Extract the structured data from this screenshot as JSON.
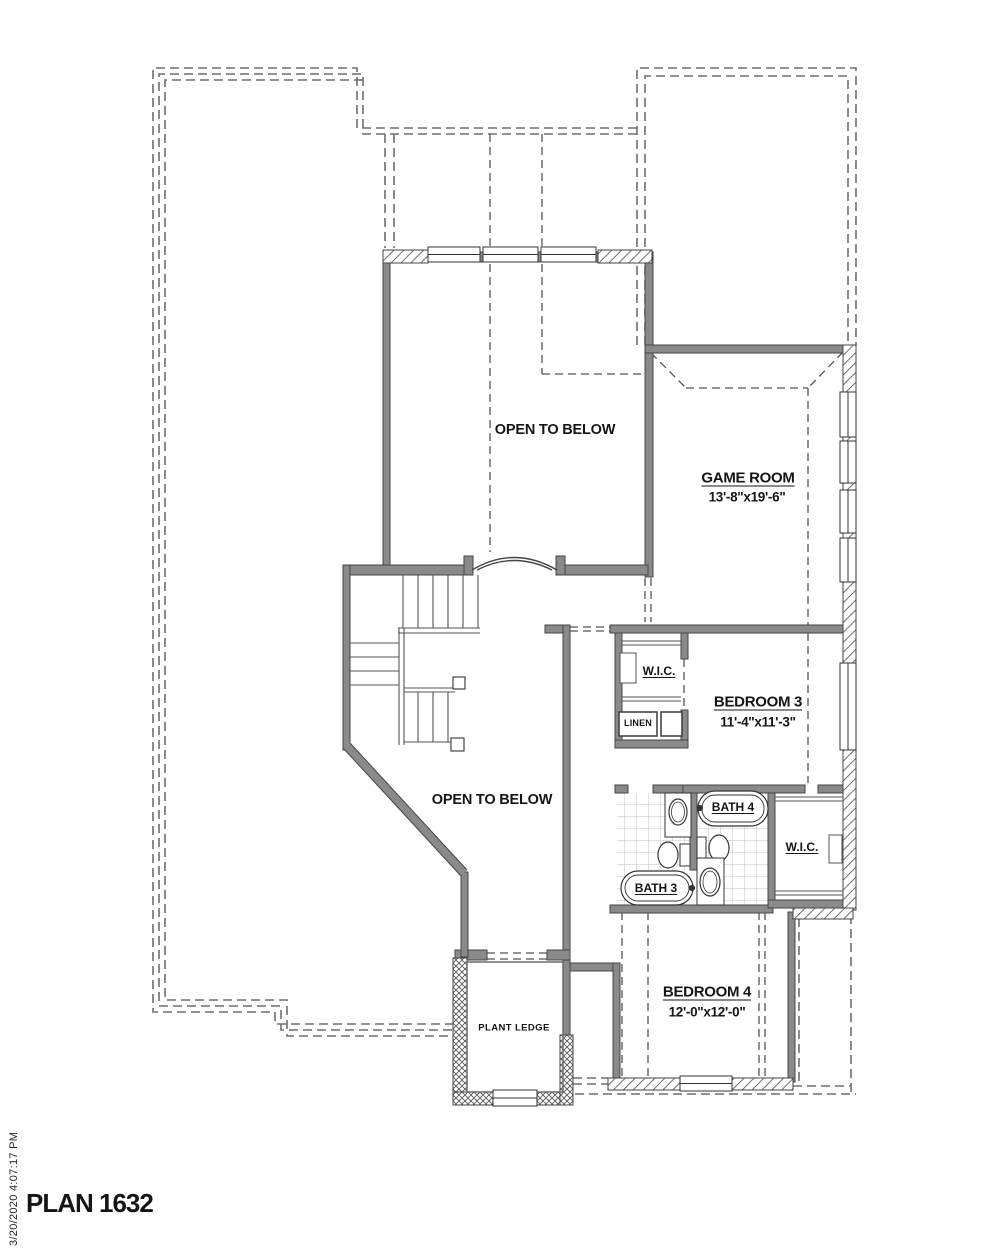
{
  "plan": {
    "title": "PLAN 1632",
    "print_timestamp": "3/20/2020 4:07:17 PM"
  },
  "rooms": {
    "open_to_below_upper": {
      "name": "OPEN TO BELOW"
    },
    "open_to_below_lower": {
      "name": "OPEN TO BELOW"
    },
    "game_room": {
      "name": "GAME ROOM",
      "dims": "13'-8\"x19'-6\""
    },
    "bedroom3": {
      "name": "BEDROOM 3",
      "dims": "11'-4\"x11'-3\""
    },
    "bedroom4": {
      "name": "BEDROOM 4",
      "dims": "12'-0\"x12'-0\""
    },
    "wic_upper": {
      "name": "W.I.C."
    },
    "wic_right": {
      "name": "W.I.C."
    },
    "linen": {
      "name": "LINEN"
    },
    "bath3": {
      "name": "BATH 3"
    },
    "bath4": {
      "name": "BATH 4"
    },
    "plant_ledge": {
      "name": "PLANT LEDGE"
    }
  },
  "colors": {
    "wall_fill": "#8a8a8a",
    "wall_edge": "#454545",
    "roof_dash": "#6e6e6e",
    "ceiling_dash": "#555555",
    "tile_line": "#c0c0c0"
  }
}
